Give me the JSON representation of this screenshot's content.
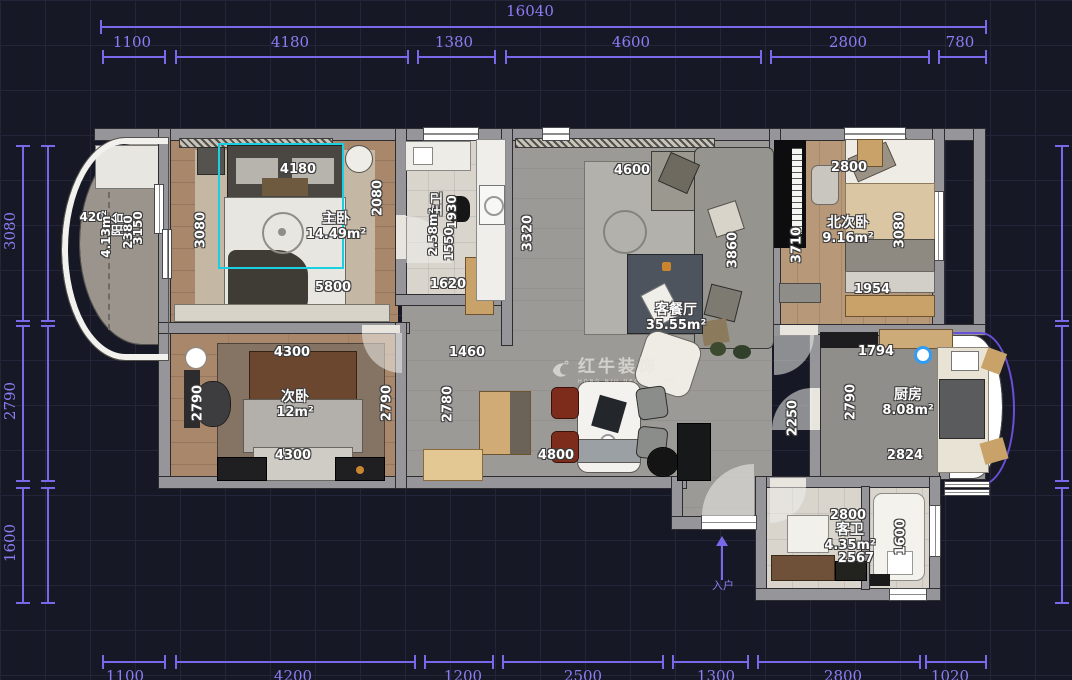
{
  "colors": {
    "dimension": "#7a68ea",
    "selection": "#19cfe2",
    "marker": "#2f9df5",
    "background": "#161925"
  },
  "watermark": {
    "name": "红牛装饰",
    "subtitle": "HONG NIU DECORATION"
  },
  "entry": {
    "label": "入户"
  },
  "dims": {
    "top_total": "16040",
    "top": [
      "1100",
      "4180",
      "1380",
      "4600",
      "2800",
      "780"
    ],
    "left": [
      "3080",
      "2790",
      "1600"
    ],
    "bottom": [
      "1100",
      "4200",
      "1200",
      "2500",
      "1300",
      "2800",
      "1020"
    ]
  },
  "rooms": {
    "master": {
      "name": "主卧",
      "area": "14.49m²",
      "d_top": "4180",
      "d_left": "3080",
      "d_right": "2080",
      "d_bottom": "5800"
    },
    "master_bath": {
      "name": "主卫",
      "area": "2.58m²",
      "d_a": "1930",
      "d_b": "1550"
    },
    "hallway": {
      "d_closet": "1620",
      "d_width": "3320",
      "d_mid": "1460",
      "d_left": "2780",
      "d_bottom": "4800",
      "d_east": "2250"
    },
    "living": {
      "name": "客餐厅",
      "area": "35.55m²",
      "d_top": "4600",
      "d_sofa": "3860"
    },
    "north": {
      "name": "北次卧",
      "area": "9.16m²",
      "d_top": "2800",
      "d_left": "3710",
      "d_right": "3080",
      "d_bottom": "1954"
    },
    "second": {
      "name": "次卧",
      "area": "12m²",
      "d_top": "4300",
      "d_left": "2790",
      "d_right": "2790",
      "d_bottom": "4300"
    },
    "kitchen": {
      "name": "厨房",
      "area": "8.08m²",
      "d_top": "1794",
      "d_left": "2790",
      "d_bottom": "2824"
    },
    "guest_bath": {
      "name": "客卫",
      "area": "4.35m²",
      "d_top": "2800",
      "d_bottom": "2567",
      "d_right": "1600"
    },
    "balcony": {
      "name": "阳台",
      "area": "4.13m²",
      "d_width": "420",
      "d_a": "3150",
      "d_b": "2380"
    }
  }
}
